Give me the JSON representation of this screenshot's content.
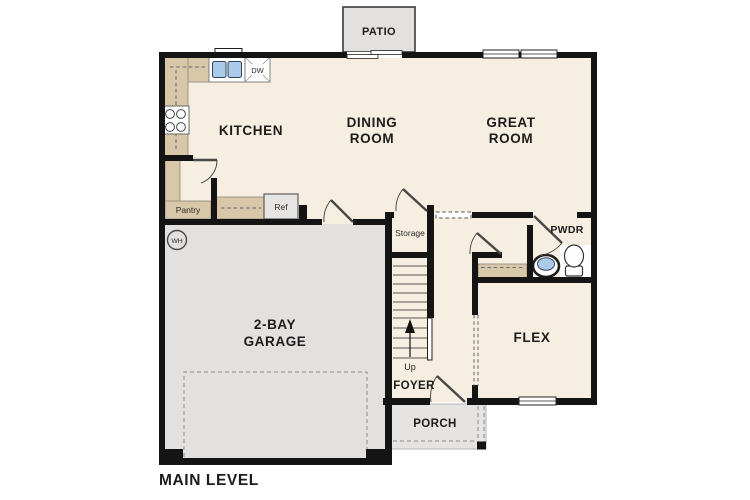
{
  "plan": {
    "title": "MAIN LEVEL",
    "rooms": {
      "patio": "PATIO",
      "kitchen": "KITCHEN",
      "dining": [
        "DINING",
        "ROOM"
      ],
      "great": [
        "GREAT",
        "ROOM"
      ],
      "garage": [
        "2-BAY",
        "GARAGE"
      ],
      "flex": "FLEX",
      "foyer": "FOYER",
      "porch": "PORCH",
      "powder": "PWDR",
      "pantry": "Pantry",
      "storage": "Storage"
    },
    "fixtures": {
      "dishwasher": "DW",
      "refrigerator": "Ref",
      "water_heater": "WH",
      "stair_direction": "Up"
    },
    "colors": {
      "floor": "#f6eee0",
      "hard_surface": "#e3e1df",
      "counter": "#d9c7aa",
      "wall": "#141414",
      "fixture_blue": "#aacbe9"
    }
  }
}
